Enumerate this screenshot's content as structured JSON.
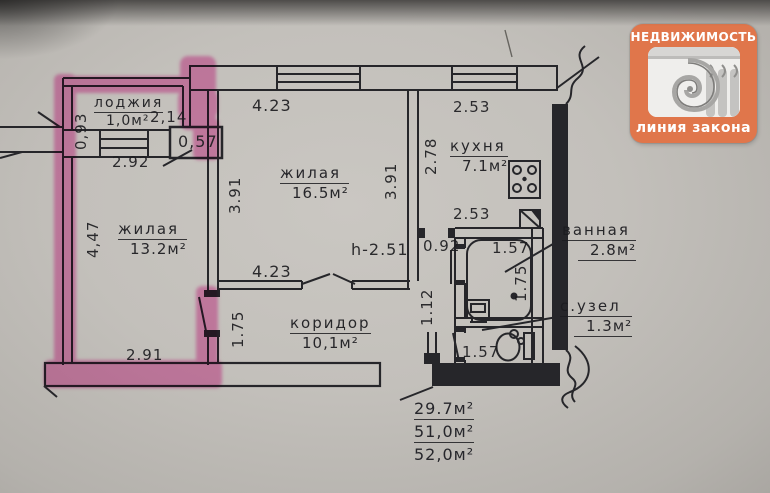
{
  "logo": {
    "title": "НЕДВИЖИМОСТЬ",
    "subtitle": "линия закона",
    "accent_color": "#e0764b"
  },
  "plan": {
    "highlight_color": "#ee3fa7",
    "rooms": {
      "loggia": {
        "name": "лоджия",
        "area": "1,0м²"
      },
      "room1": {
        "name": "жилая",
        "area": "13.2м²"
      },
      "room2": {
        "name": "жилая",
        "area": "16.5м²"
      },
      "kitchen": {
        "name": "кухня",
        "area": "7.1м²"
      },
      "bathroom": {
        "name": "ванная",
        "area": "2.8м²"
      },
      "wc": {
        "name": "с.узел",
        "area": "1.3м²"
      },
      "corridor": {
        "name": "коридор",
        "area": "10,1м²"
      }
    },
    "dimensions": {
      "d093": "0,93",
      "d214": "2,14",
      "d057": "0,57",
      "d292": "2.92",
      "d447": "4,47",
      "d291": "2.91",
      "d423_top": "4.23",
      "d391_left": "3.91",
      "d391_right": "3.91",
      "d253_top": "2.53",
      "d278": "2.78",
      "d253_mid": "2.53",
      "d092": "0.92",
      "h251": "h-2.51",
      "d112": "1.12",
      "d175_corr": "1.75",
      "d423_corr": "4.23",
      "d157_bath": "1.57",
      "d175_bath": "1.75",
      "d157_wc": "1.57"
    },
    "totals": {
      "line1": "29.7м²",
      "line2": "51,0м²",
      "line3": "52,0м²"
    }
  }
}
